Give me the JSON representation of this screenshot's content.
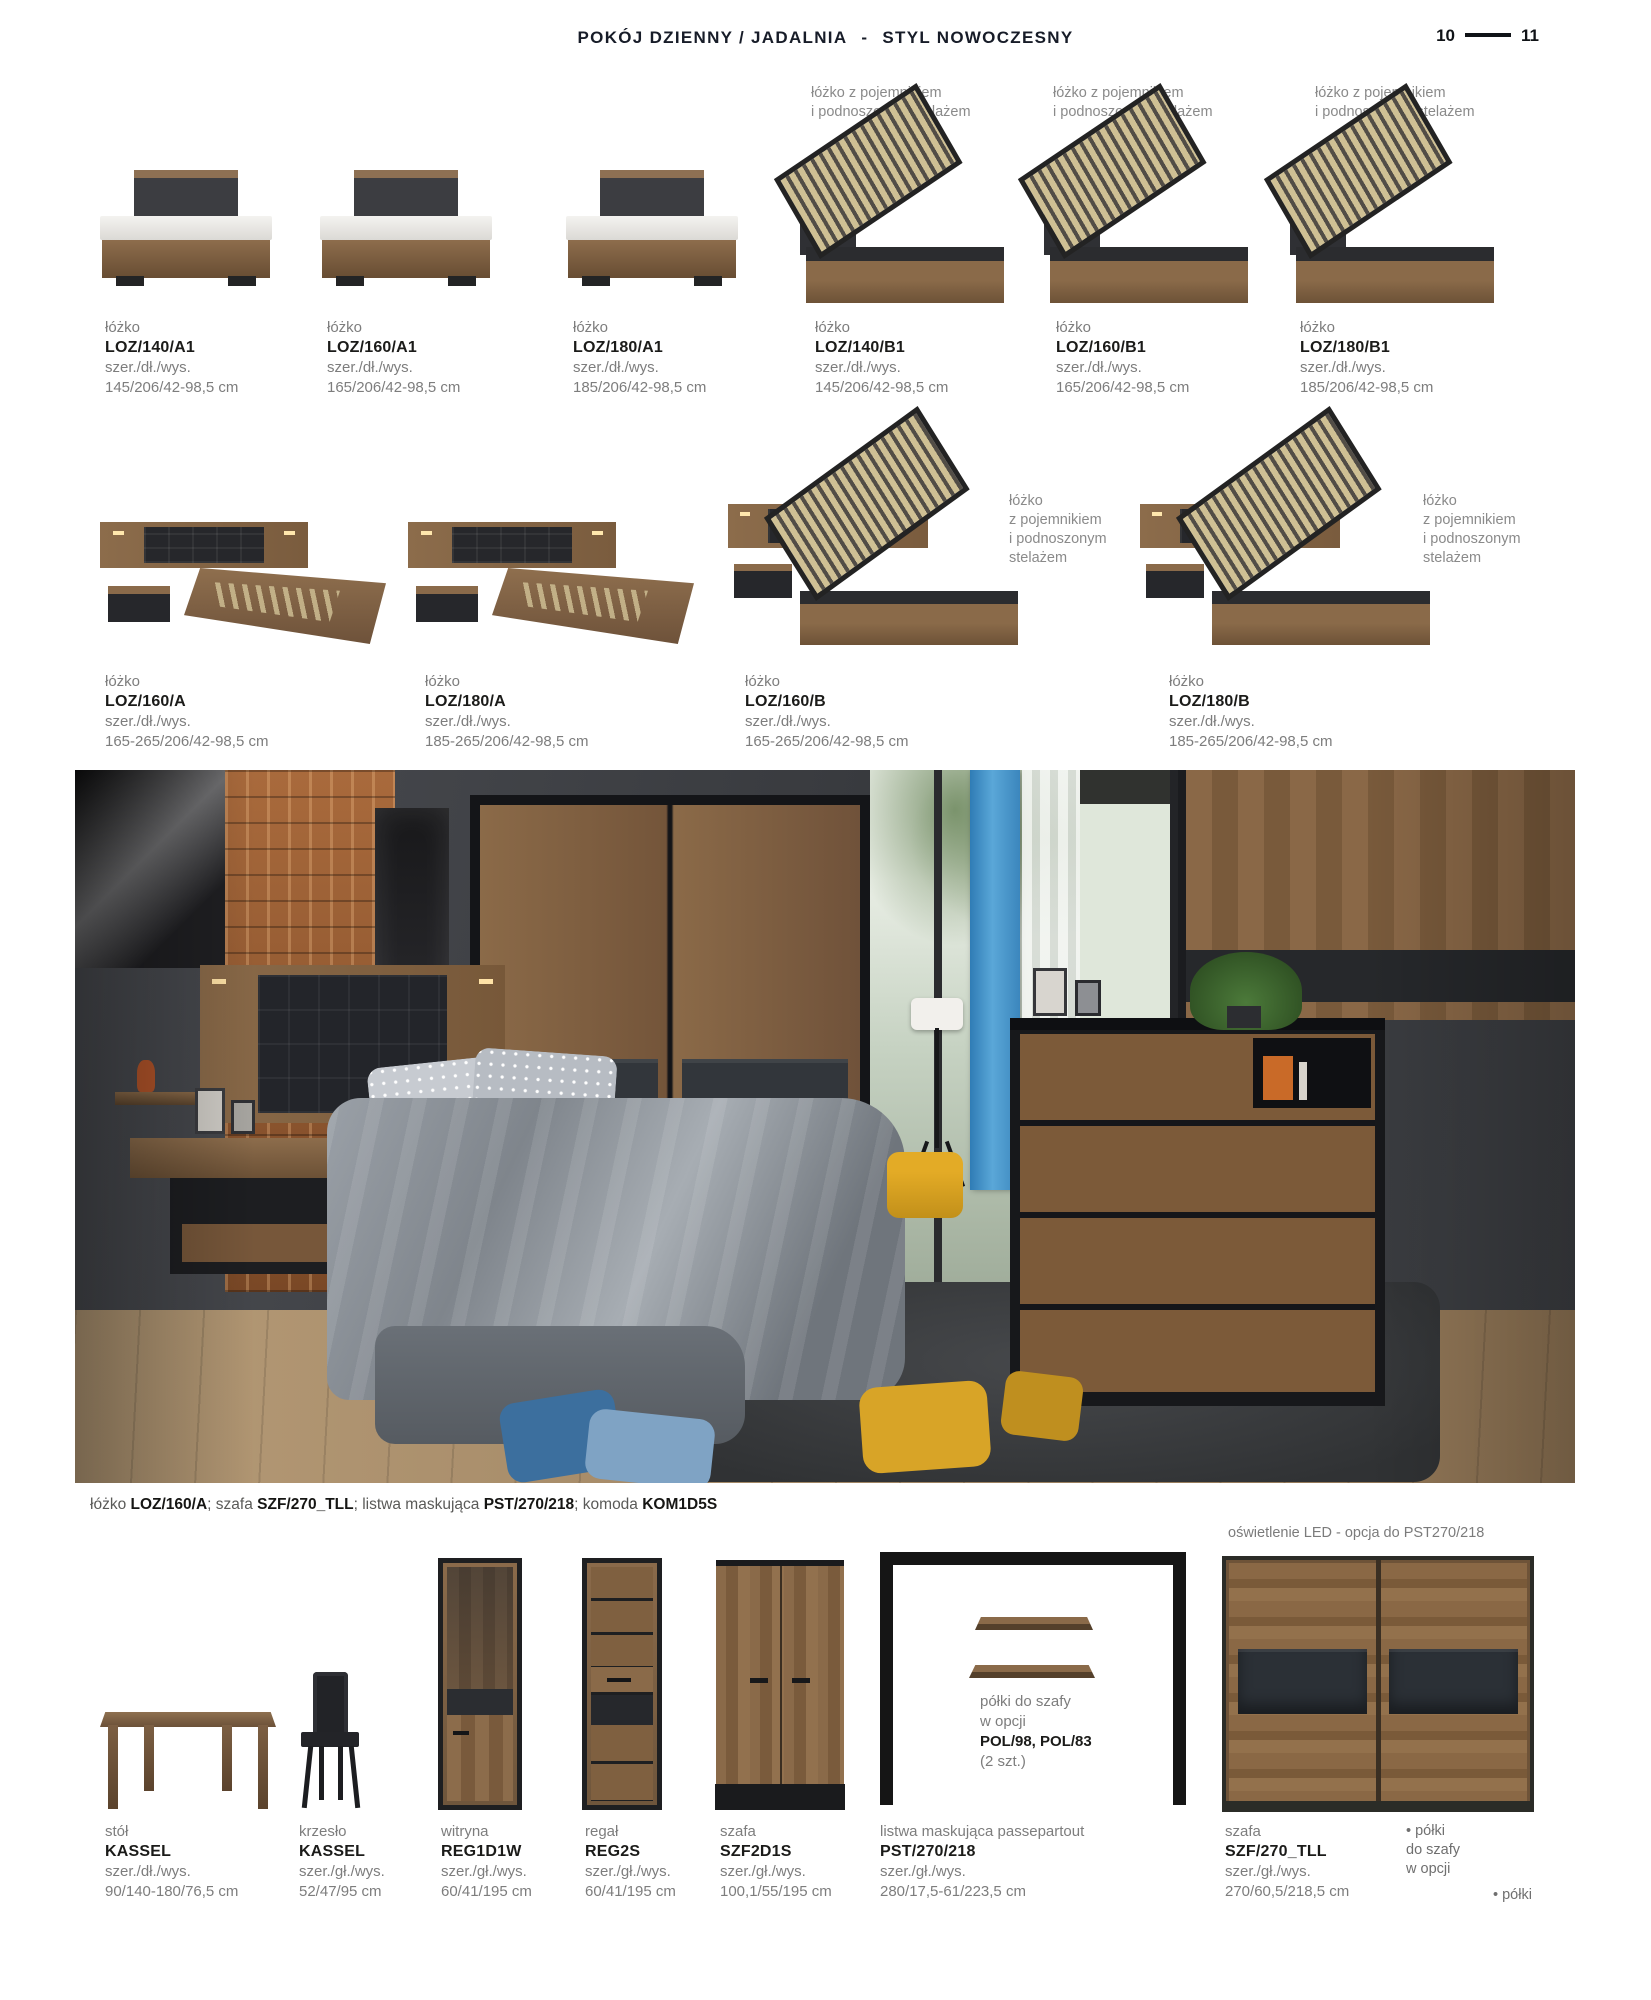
{
  "header": {
    "title": "POKÓJ DZIENNY / JADALNIA",
    "separator": "-",
    "subtitle": "STYL NOWOCZESNY",
    "page_left": "10",
    "page_right": "11"
  },
  "row1": {
    "lift_caption": {
      "line1": "łóżko z pojemnikiem",
      "line2": "i podnoszonym stelażem"
    },
    "products": [
      {
        "type": "łóżko",
        "code": "LOZ/140/A1",
        "dims_label": "szer./dł./wys.",
        "dims": "145/206/42-98,5 cm"
      },
      {
        "type": "łóżko",
        "code": "LOZ/160/A1",
        "dims_label": "szer./dł./wys.",
        "dims": "165/206/42-98,5 cm"
      },
      {
        "type": "łóżko",
        "code": "LOZ/180/A1",
        "dims_label": "szer./dł./wys.",
        "dims": "185/206/42-98,5 cm"
      },
      {
        "type": "łóżko",
        "code": "LOZ/140/B1",
        "dims_label": "szer./dł./wys.",
        "dims": "145/206/42-98,5 cm"
      },
      {
        "type": "łóżko",
        "code": "LOZ/160/B1",
        "dims_label": "szer./dł./wys.",
        "dims": "165/206/42-98,5 cm"
      },
      {
        "type": "łóżko",
        "code": "LOZ/180/B1",
        "dims_label": "szer./dł./wys.",
        "dims": "185/206/42-98,5 cm"
      }
    ]
  },
  "row2": {
    "lift_caption": {
      "l1": "łóżko",
      "l2": "z pojemnikiem",
      "l3": "i podnoszonym",
      "l4": "stelażem"
    },
    "products": [
      {
        "type": "łóżko",
        "code": "LOZ/160/A",
        "dims_label": "szer./dł./wys.",
        "dims": "165-265/206/42-98,5 cm"
      },
      {
        "type": "łóżko",
        "code": "LOZ/180/A",
        "dims_label": "szer./dł./wys.",
        "dims": "185-265/206/42-98,5 cm"
      },
      {
        "type": "łóżko",
        "code": "LOZ/160/B",
        "dims_label": "szer./dł./wys.",
        "dims": "165-265/206/42-98,5 cm"
      },
      {
        "type": "łóżko",
        "code": "LOZ/180/B",
        "dims_label": "szer./dł./wys.",
        "dims": "185-265/206/42-98,5 cm"
      }
    ]
  },
  "photo_caption": {
    "seg1": "łóżko ",
    "seg2": "LOZ/160/A",
    "seg3": "; szafa ",
    "seg4": "SZF/270_TLL",
    "seg5": "; listwa maskująca ",
    "seg6": "PST/270/218",
    "seg7": "; komoda ",
    "seg8": "KOM1D5S"
  },
  "bottom": {
    "led_note": "oświetlenie LED - opcja do PST270/218",
    "frame_note": {
      "line1": "półki do szafy",
      "line2": "w opcji",
      "line3": "POL/98, POL/83",
      "line4": "(2 szt.)"
    },
    "bullet1": {
      "line1": "• półki",
      "line2": "do szafy",
      "line3": "w opcji"
    },
    "bullet2": "• półki",
    "products": [
      {
        "type": "stół",
        "code": "KASSEL",
        "dims_label": "szer./dł./wys.",
        "dims": "90/140-180/76,5 cm"
      },
      {
        "type": "krzesło",
        "code": "KASSEL",
        "dims_label": "szer./gł./wys.",
        "dims": "52/47/95 cm"
      },
      {
        "type": "witryna",
        "code": "REG1D1W",
        "dims_label": "szer./gł./wys.",
        "dims": "60/41/195 cm"
      },
      {
        "type": "regał",
        "code": "REG2S",
        "dims_label": "szer./gł./wys.",
        "dims": "60/41/195 cm"
      },
      {
        "type": "szafa",
        "code": "SZF2D1S",
        "dims_label": "szer./gł./wys.",
        "dims": "100,1/55/195 cm"
      },
      {
        "type": "listwa maskująca passepartout",
        "code": "PST/270/218",
        "dims_label": "szer./gł./wys.",
        "dims": "280/17,5-61/223,5 cm"
      },
      {
        "type": "szafa",
        "code": "SZF/270_TLL",
        "dims_label": "szer./gł./wys.",
        "dims": "270/60,5/218,5 cm"
      }
    ]
  },
  "colors": {
    "header_text": "#171c28",
    "wood": "#8a6a4a",
    "dark_furniture": "#2b2c2f",
    "blue_curtain": "#3f8fc6",
    "mustard": "#d7a023"
  }
}
